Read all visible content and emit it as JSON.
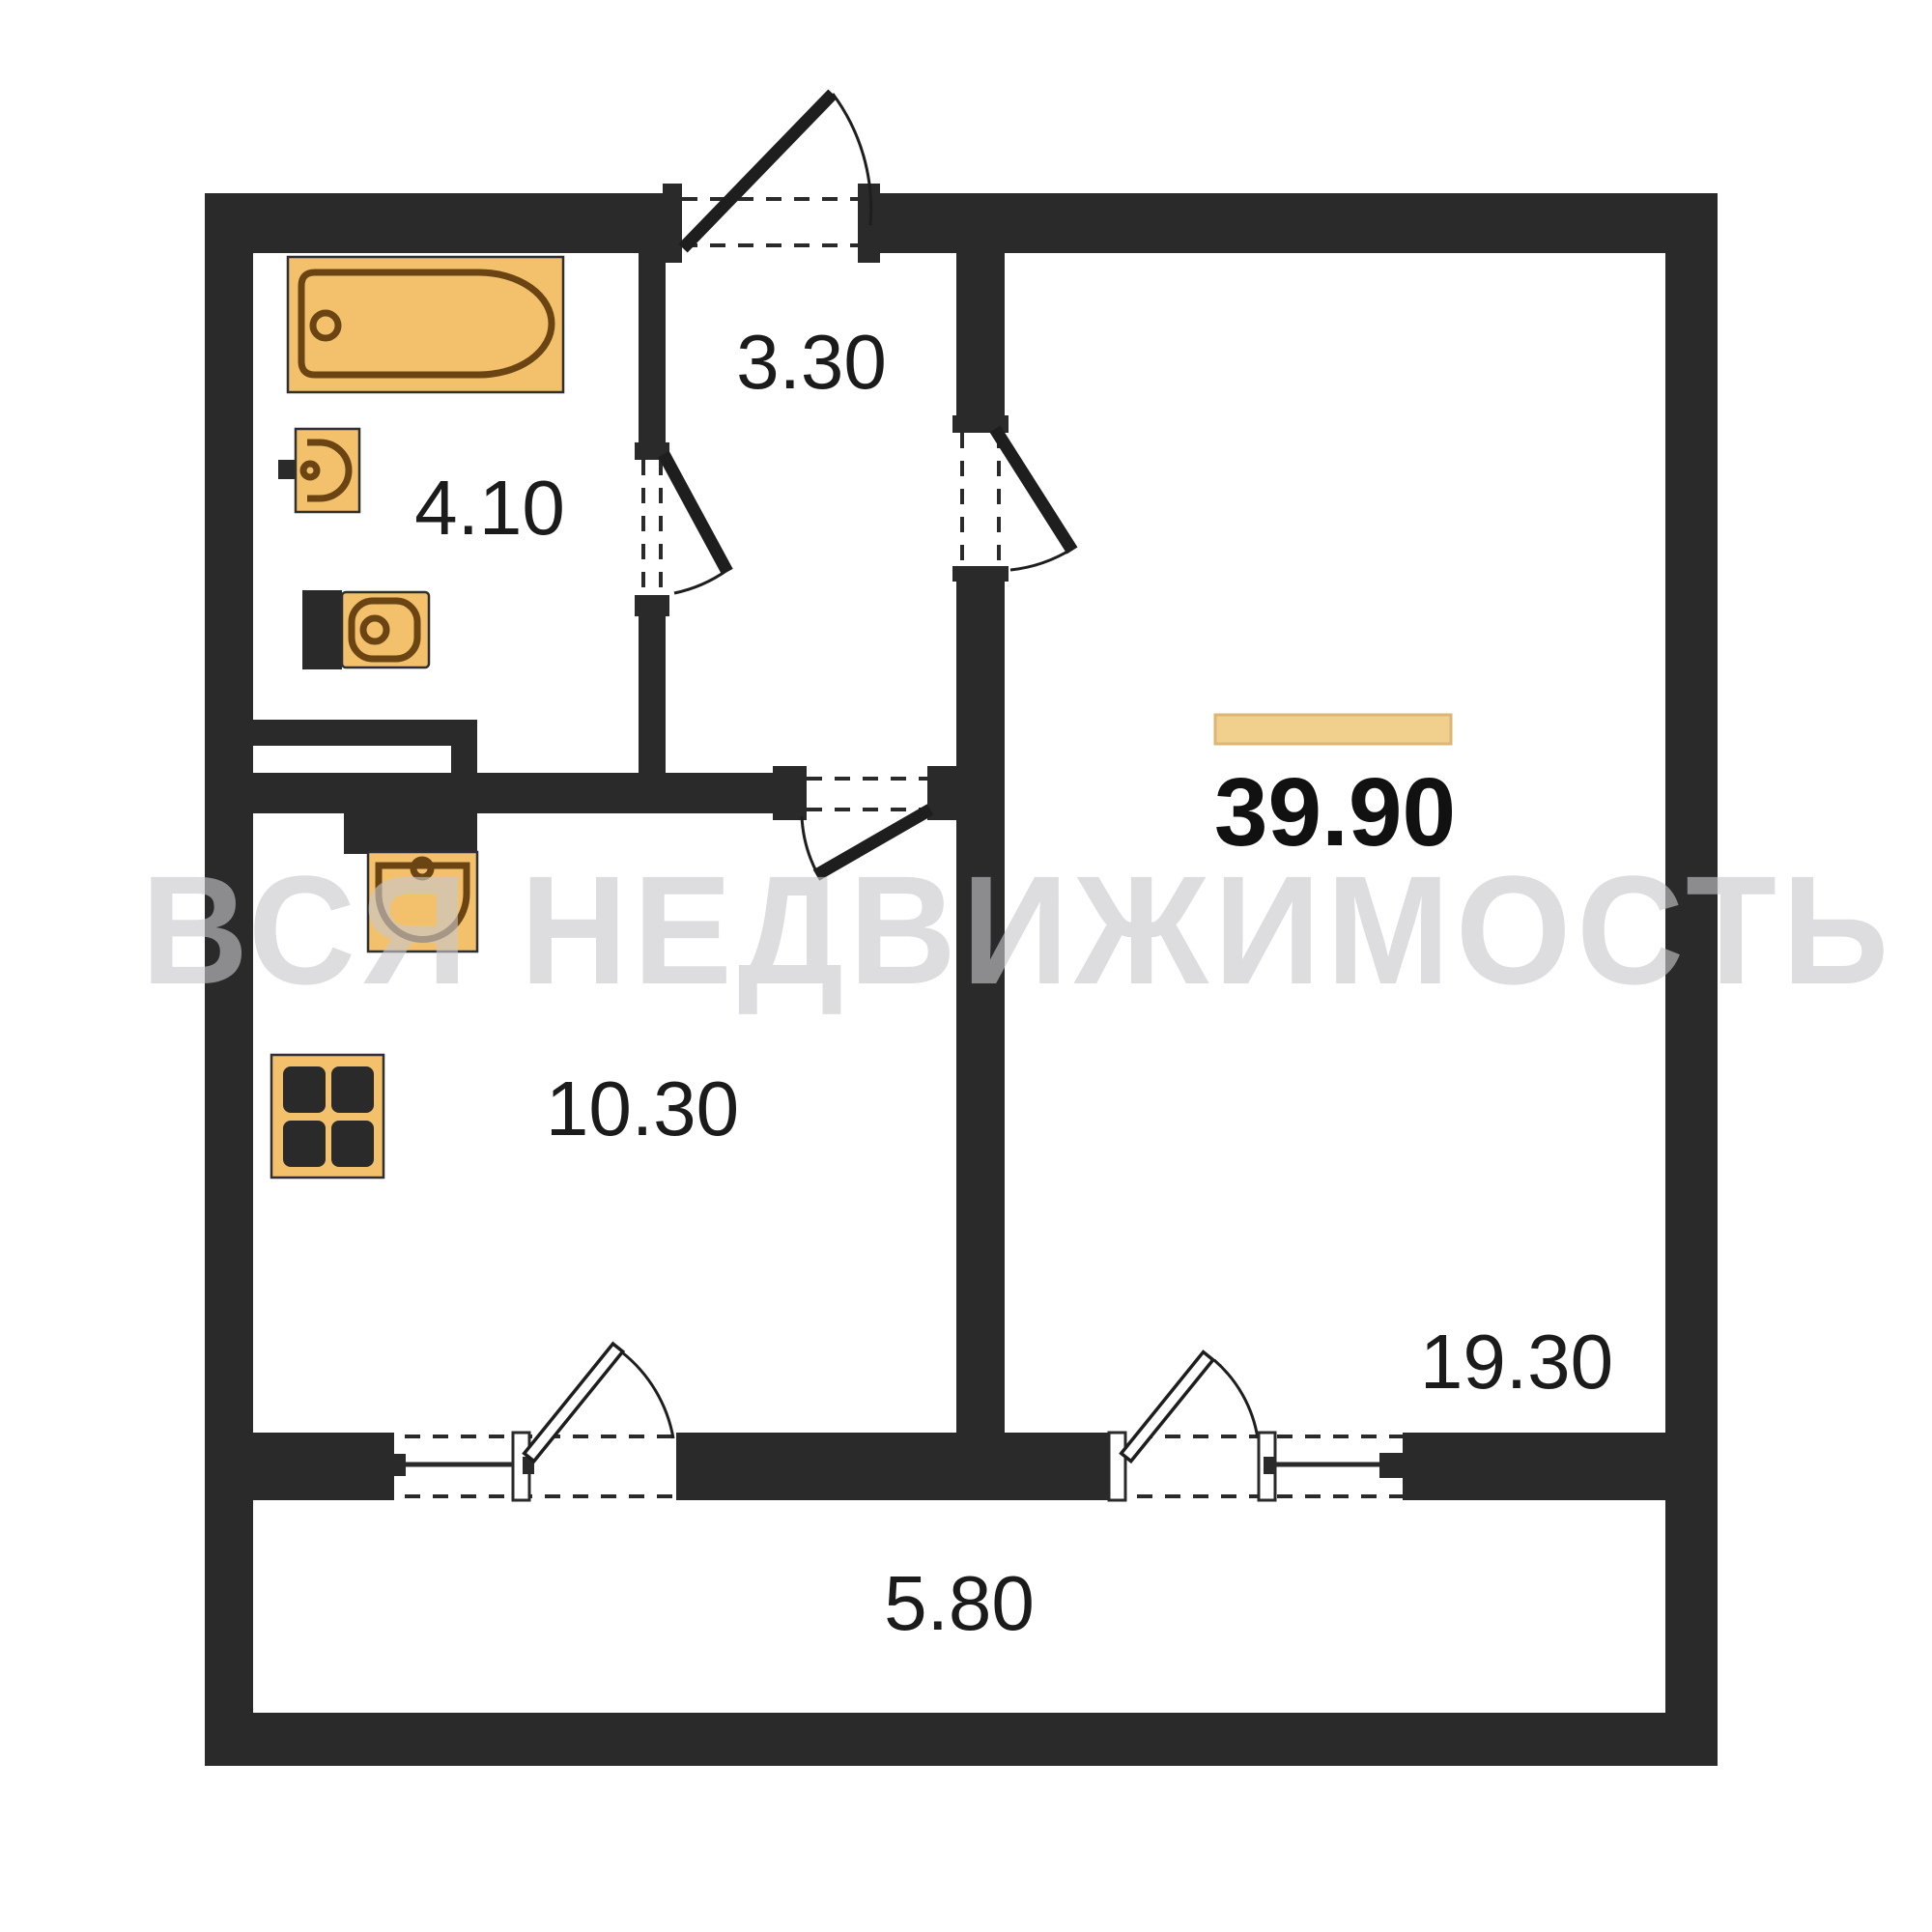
{
  "floorplan": {
    "title": "1-room apartment floor plan",
    "total_area": "39.90",
    "watermark_text": "ВСЯ НЕДВИЖИМОСТЬ",
    "rooms": [
      {
        "name": "hallway",
        "area": "3.30"
      },
      {
        "name": "bathroom",
        "area": "4.10"
      },
      {
        "name": "kitchen",
        "area": "10.30"
      },
      {
        "name": "living-room",
        "area": "19.30"
      },
      {
        "name": "balcony",
        "area": "5.80"
      }
    ],
    "fixtures": [
      "bathtub",
      "washbasin",
      "toilet",
      "kitchen-sink",
      "stove"
    ],
    "colors": {
      "wall": "#2a2a2a",
      "fixture_fill": "#F3C16B",
      "fixture_fill_light": "#F6C873",
      "fixture_outline": "#6b4413",
      "highlight_fill": "#F0D08C",
      "highlight_border": "#DDB672",
      "watermark_color": "#c9c9cd",
      "label_color": "#1b1b1b"
    }
  }
}
